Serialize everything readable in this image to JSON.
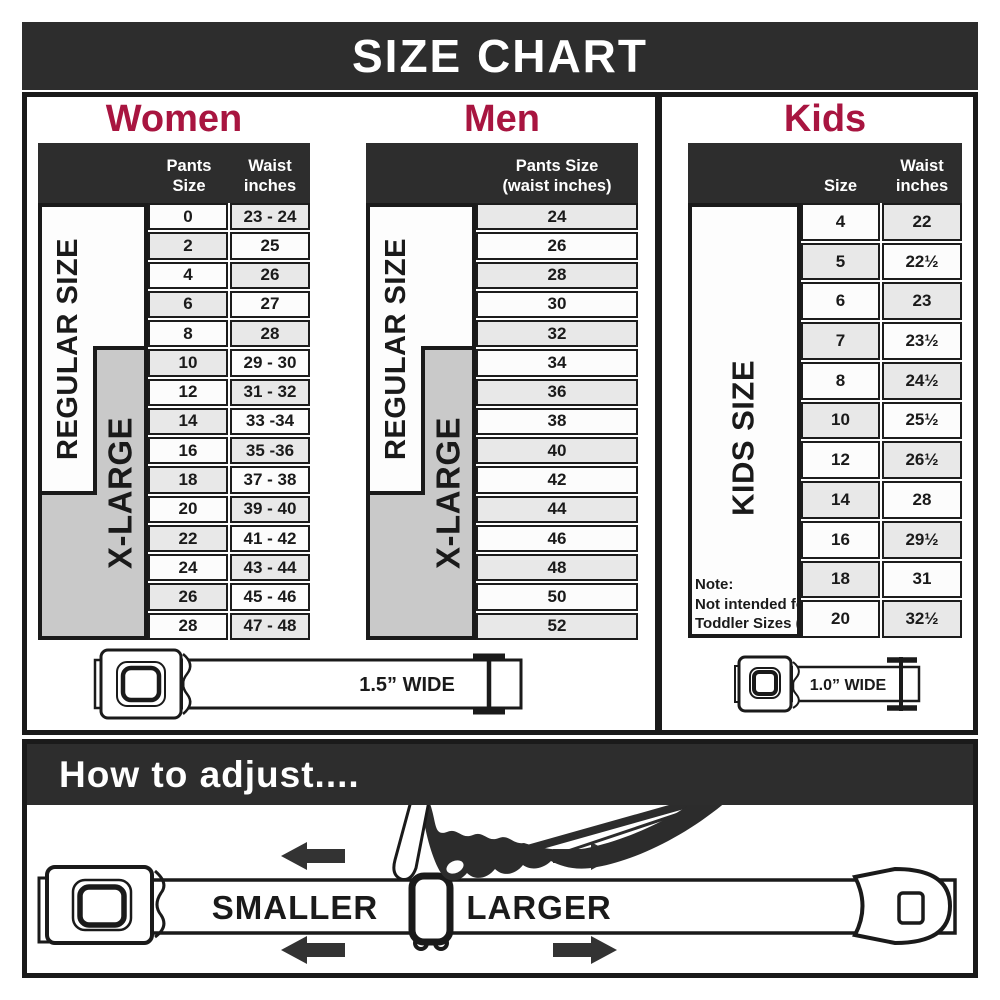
{
  "title": "SIZE CHART",
  "colors": {
    "accent": "#a81540",
    "dark": "#2d2d2d",
    "row_alt": "#e8e8e8",
    "label_gray": "#c9c9c9",
    "border": "#1a1a1a"
  },
  "women": {
    "heading": "Women",
    "columns": {
      "col1": "Pants Size",
      "col2_line1": "Waist",
      "col2_line2": "inches"
    },
    "side_labels": {
      "regular": "REGULAR SIZE",
      "xlarge": "X-LARGE"
    },
    "rows": [
      {
        "size": "0",
        "waist": "23 - 24"
      },
      {
        "size": "2",
        "waist": "25"
      },
      {
        "size": "4",
        "waist": "26"
      },
      {
        "size": "6",
        "waist": "27"
      },
      {
        "size": "8",
        "waist": "28"
      },
      {
        "size": "10",
        "waist": "29 - 30"
      },
      {
        "size": "12",
        "waist": "31 - 32"
      },
      {
        "size": "14",
        "waist": "33 -34"
      },
      {
        "size": "16",
        "waist": "35 -36"
      },
      {
        "size": "18",
        "waist": "37 - 38"
      },
      {
        "size": "20",
        "waist": "39 - 40"
      },
      {
        "size": "22",
        "waist": "41 - 42"
      },
      {
        "size": "24",
        "waist": "43 - 44"
      },
      {
        "size": "26",
        "waist": "45 - 46"
      },
      {
        "size": "28",
        "waist": "47 - 48"
      }
    ]
  },
  "men": {
    "heading": "Men",
    "columns": {
      "col_line1": "Pants Size",
      "col_line2": "(waist inches)"
    },
    "side_labels": {
      "regular": "REGULAR SIZE",
      "xlarge": "X-LARGE"
    },
    "rows": [
      "24",
      "26",
      "28",
      "30",
      "32",
      "34",
      "36",
      "38",
      "40",
      "42",
      "44",
      "46",
      "48",
      "50",
      "52"
    ]
  },
  "kids": {
    "heading": "Kids",
    "columns": {
      "col1": "Size",
      "col2_line1": "Waist",
      "col2_line2": "inches"
    },
    "side_label": "KIDS SIZE",
    "note": {
      "line1": "Note:",
      "line2": "Not intended for",
      "line3": "Toddler Sizes (T)"
    },
    "rows": [
      {
        "size": "4",
        "waist": "22"
      },
      {
        "size": "5",
        "waist": "22½"
      },
      {
        "size": "6",
        "waist": "23"
      },
      {
        "size": "7",
        "waist": "23½"
      },
      {
        "size": "8",
        "waist": "24½"
      },
      {
        "size": "10",
        "waist": "25½"
      },
      {
        "size": "12",
        "waist": "26½"
      },
      {
        "size": "14",
        "waist": "28"
      },
      {
        "size": "16",
        "waist": "29½"
      },
      {
        "size": "18",
        "waist": "31"
      },
      {
        "size": "20",
        "waist": "32½"
      }
    ]
  },
  "belts": {
    "adult_width_label": "1.5” WIDE",
    "kids_width_label": "1.0” WIDE"
  },
  "adjust": {
    "heading": "How to adjust....",
    "smaller": "SMALLER",
    "larger": "LARGER"
  }
}
